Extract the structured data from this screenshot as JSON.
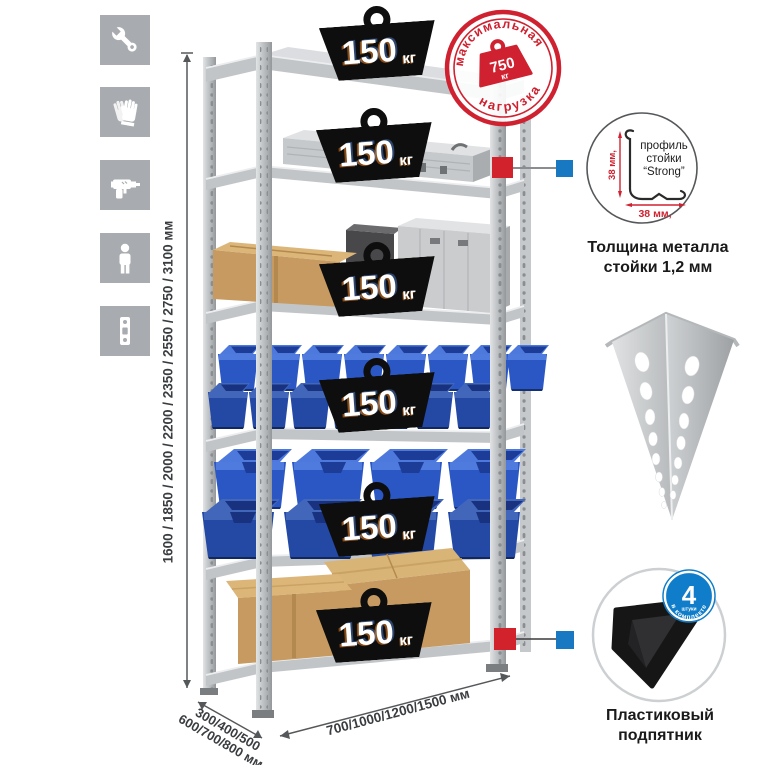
{
  "sidebar": {
    "icons": [
      {
        "name": "wrench-icon"
      },
      {
        "name": "gloves-icon"
      },
      {
        "name": "drill-icon"
      },
      {
        "name": "person-icon"
      },
      {
        "name": "rack-post-icon"
      }
    ]
  },
  "rack": {
    "weights": [
      {
        "value": "150",
        "unit": "кг"
      },
      {
        "value": "150",
        "unit": "кг"
      },
      {
        "value": "150",
        "unit": "кг"
      },
      {
        "value": "150",
        "unit": "кг"
      },
      {
        "value": "150",
        "unit": "кг"
      },
      {
        "value": "150",
        "unit": "кг"
      }
    ]
  },
  "stamp": {
    "arc_top": "максимальная",
    "arc_bottom": "нагрузка",
    "value": "750",
    "unit": "кг"
  },
  "dimensions": {
    "height": "1600 / 1850 / 2000 / 2200 / 2350 / 2550 / 2750 / 3100 мм",
    "depth_line1": "300/400/500",
    "depth_line2": "600/700/800 мм",
    "width": "700/1000/1200/1500 мм"
  },
  "profile_detail": {
    "label_line1": "профиль",
    "label_line2": "стойки",
    "label_line3": "“Strong”",
    "dim_vertical": "38 мм,",
    "dim_horizontal": "38 мм,",
    "caption_line1": "Толщина металла",
    "caption_line2": "стойки 1,2 мм"
  },
  "foot_detail": {
    "badge_number": "4",
    "badge_word": "штуки",
    "badge_arc": "в комплекте",
    "caption_line1": "Пластиковый",
    "caption_line2": "подпятник"
  },
  "colors": {
    "accent_red": "#d2232d",
    "accent_blue": "#1878c2",
    "stamp_red": "#cf2130",
    "metal": "#c2c5c8",
    "bin_blue": "#2a57c4",
    "cardboard": "#c69a60"
  }
}
